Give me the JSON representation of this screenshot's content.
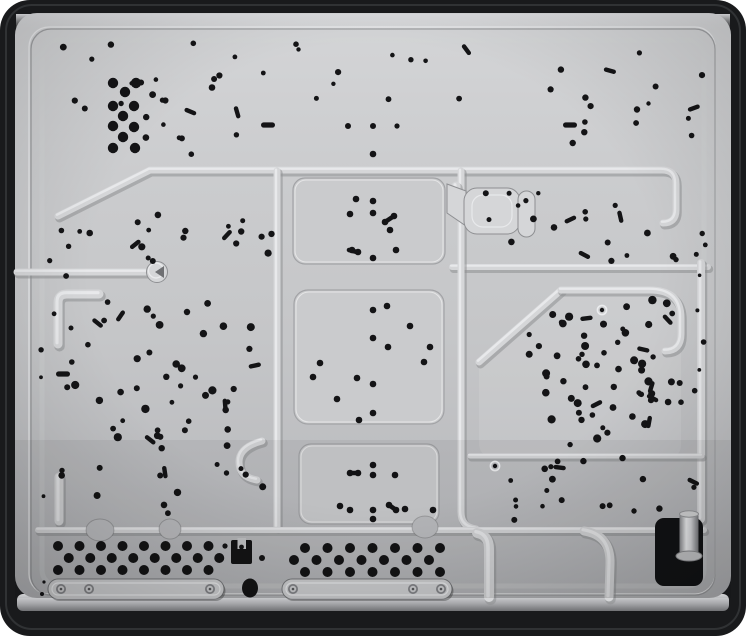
{
  "meta": {
    "description": "Product photograph: underside of a built-in gas hob. Black rounded frame around a stamped galvanised-steel base panel covered in small black fastening holes, burner mounting hole rings, ventilation perforation fields, two screw-fixed mounting rails, a clamp bracket, an oval hole and a black gas-inlet recess with a metal pipe stub at lower right."
  },
  "palette": {
    "background": "#ffffff",
    "frame": "#191a1c",
    "frame_highlight": "#36383b",
    "panel_light": "#d4d5d7",
    "panel_mid": "#c5c6c8",
    "panel_dark": "#b2b3b6",
    "bevel_light": "#dcdde0",
    "bevel_dark": "#707174",
    "shadow_strip": "#242527",
    "ridge_highlight": "#ebecee",
    "ridge_face": "#d5d6d8",
    "ridge_shadow": "#8e8f92",
    "raised_panel": "#cacbcd",
    "edge_dark": "#a2a3a6",
    "hole": "#141416",
    "screw_face": "#cfd0d2",
    "screw_ring": "#85868a",
    "gas_box": "#121315",
    "pipe_light": "#f1f2f4",
    "pipe_dark": "#8a8b8f"
  },
  "features": {
    "fields": [
      {
        "name": "top-left-holes",
        "x": 58,
        "y": 38,
        "w": 210,
        "h": 118,
        "count": 24,
        "rmin": 2.2,
        "rmax": 3.6,
        "pairs": 3,
        "seed": 11
      },
      {
        "name": "top-center-holes",
        "x": 295,
        "y": 40,
        "w": 210,
        "h": 88,
        "count": 10,
        "rmin": 2.0,
        "rmax": 3.2,
        "pairs": 1,
        "seed": 22
      },
      {
        "name": "top-right-holes",
        "x": 548,
        "y": 38,
        "w": 160,
        "h": 115,
        "count": 15,
        "rmin": 2.0,
        "rmax": 3.4,
        "pairs": 2,
        "seed": 33
      },
      {
        "name": "mid-left-holes",
        "x": 88,
        "y": 213,
        "w": 185,
        "h": 48,
        "count": 16,
        "rmin": 2.4,
        "rmax": 3.8,
        "pairs": 2,
        "seed": 44
      },
      {
        "name": "mid-left-edge-holes",
        "x": 46,
        "y": 228,
        "w": 45,
        "h": 55,
        "count": 5,
        "rmin": 2.2,
        "rmax": 3.2,
        "pairs": 0,
        "seed": 55
      },
      {
        "name": "mid-right-holes",
        "x": 475,
        "y": 193,
        "w": 235,
        "h": 68,
        "count": 20,
        "rmin": 2.2,
        "rmax": 3.6,
        "pairs": 3,
        "seed": 66
      },
      {
        "name": "left-panel-holes",
        "x": 60,
        "y": 300,
        "w": 205,
        "h": 215,
        "count": 58,
        "rmin": 2.4,
        "rmax": 4.2,
        "pairs": 6,
        "seed": 77
      },
      {
        "name": "right-panel-holes",
        "x": 527,
        "y": 300,
        "w": 148,
        "h": 146,
        "count": 44,
        "rmin": 2.4,
        "rmax": 4.2,
        "pairs": 5,
        "seed": 88
      },
      {
        "name": "right-panel-lower-holes",
        "x": 545,
        "y": 370,
        "w": 140,
        "h": 62,
        "count": 14,
        "rmin": 2.4,
        "rmax": 3.8,
        "pairs": 2,
        "seed": 99
      },
      {
        "name": "right-lower-strip-holes",
        "x": 540,
        "y": 458,
        "w": 160,
        "h": 55,
        "count": 13,
        "rmin": 2.4,
        "rmax": 3.6,
        "pairs": 2,
        "seed": 101
      },
      {
        "name": "center-gap-holes",
        "x": 488,
        "y": 450,
        "w": 55,
        "h": 70,
        "count": 5,
        "rmin": 2.2,
        "rmax": 3.2,
        "pairs": 0,
        "seed": 111
      },
      {
        "name": "right-margin-holes",
        "x": 693,
        "y": 190,
        "w": 22,
        "h": 310,
        "count": 7,
        "rmin": 1.8,
        "rmax": 2.8,
        "pairs": 0,
        "seed": 121
      },
      {
        "name": "left-margin-holes",
        "x": 40,
        "y": 300,
        "w": 18,
        "h": 200,
        "count": 4,
        "rmin": 1.8,
        "rmax": 2.8,
        "pairs": 0,
        "seed": 131
      }
    ],
    "big_hole_strip": {
      "r": 5.2,
      "points": [
        [
          113,
          83
        ],
        [
          136,
          83
        ],
        [
          125,
          92
        ],
        [
          113,
          106
        ],
        [
          134,
          106
        ],
        [
          123,
          116
        ],
        [
          113,
          126
        ],
        [
          134,
          127
        ],
        [
          123,
          137
        ],
        [
          113,
          148
        ],
        [
          135,
          148
        ]
      ]
    },
    "burner_rings": [
      {
        "name": "top-burner-holes",
        "r": 3.3,
        "points": [
          [
            356,
            199
          ],
          [
            373,
            201
          ],
          [
            350,
            214
          ],
          [
            373,
            213
          ],
          [
            390,
            230
          ],
          [
            373,
            258
          ],
          [
            396,
            250
          ],
          [
            352,
            250
          ],
          [
            358,
            252
          ],
          [
            385,
            222
          ],
          [
            394,
            216
          ],
          [
            373,
            154
          ]
        ]
      },
      {
        "name": "middle-burner-holes",
        "r": 3.3,
        "points": [
          [
            387,
            306
          ],
          [
            373,
            310
          ],
          [
            410,
            326
          ],
          [
            373,
            338
          ],
          [
            388,
            347
          ],
          [
            430,
            347
          ],
          [
            424,
            362
          ],
          [
            320,
            363
          ],
          [
            313,
            377
          ],
          [
            357,
            378
          ],
          [
            373,
            384
          ],
          [
            337,
            399
          ],
          [
            373,
            413
          ],
          [
            359,
            420
          ]
        ]
      },
      {
        "name": "bottom-burner-holes",
        "r": 3.3,
        "points": [
          [
            373,
            465
          ],
          [
            350,
            473
          ],
          [
            358,
            473
          ],
          [
            373,
            475
          ],
          [
            395,
            475
          ],
          [
            340,
            506
          ],
          [
            350,
            510
          ],
          [
            373,
            510
          ],
          [
            389,
            505
          ],
          [
            396,
            510
          ],
          [
            405,
            509
          ],
          [
            433,
            510
          ],
          [
            373,
            519
          ]
        ]
      }
    ],
    "hole_bars": [
      [
        385,
        222,
        394,
        216
      ],
      [
        349,
        250,
        357,
        252
      ],
      [
        350,
        473,
        358,
        473
      ],
      [
        389,
        505,
        396,
        510
      ]
    ],
    "ring_holes": [
      [
        495,
        466
      ],
      [
        602,
        310
      ]
    ],
    "slots": [
      [
        268,
        125
      ],
      [
        570,
        125
      ],
      [
        63,
        374
      ]
    ],
    "row_dots": [
      [
        348,
        126,
        3
      ],
      [
        373,
        126,
        3
      ],
      [
        397,
        126,
        2.6
      ],
      [
        225,
        546,
        2.6
      ],
      [
        262,
        558,
        3
      ],
      [
        44,
        582,
        1.6
      ],
      [
        42,
        594,
        2.0
      ]
    ],
    "vents": [
      {
        "name": "left-vent-field",
        "x0": 58,
        "y0": 546,
        "cols": 8,
        "rows": 3,
        "dx": 21.5,
        "dy": 12,
        "stagger": 10.75,
        "r": 5
      },
      {
        "name": "center-vent-field",
        "x0": 305,
        "y0": 548,
        "cols": 7,
        "rows": 3,
        "dx": 22.5,
        "dy": 12,
        "stagger": -11,
        "r": 5
      }
    ],
    "rails": [
      {
        "name": "left-mounting-rail",
        "x": 48,
        "y": 579,
        "w": 176,
        "h": 20,
        "screws": [
          [
            61,
            589
          ],
          [
            89,
            589
          ],
          [
            210,
            589
          ]
        ]
      },
      {
        "name": "center-mounting-rail",
        "x": 282,
        "y": 579,
        "w": 170,
        "h": 20,
        "screws": [
          [
            293,
            589
          ],
          [
            413,
            589
          ],
          [
            441,
            589
          ]
        ]
      }
    ],
    "bracket": {
      "x": 231,
      "y": 540,
      "w": 21,
      "h": 24,
      "notch_x": 237.5,
      "notch_y": 538,
      "notch_w": 8.5,
      "notch_h": 11,
      "hole_x": 241.5,
      "hole_y": 547,
      "hole_r": 2.4
    },
    "oval_hole": {
      "cx": 250,
      "cy": 588,
      "rx": 8,
      "ry": 9.5
    },
    "gas_box": {
      "x": 655,
      "y": 518,
      "w": 48,
      "h": 68,
      "rx": 9,
      "pipe_x": 679.5,
      "pipe_y": 514,
      "pipe_w": 19,
      "pipe_h": 42,
      "flange_cx": 689,
      "flange_cy": 556,
      "flange_rx": 13,
      "flange_ry": 5,
      "cap_cx": 689,
      "cap_cy": 514,
      "cap_rx": 9.5,
      "cap_ry": 3.2
    }
  }
}
